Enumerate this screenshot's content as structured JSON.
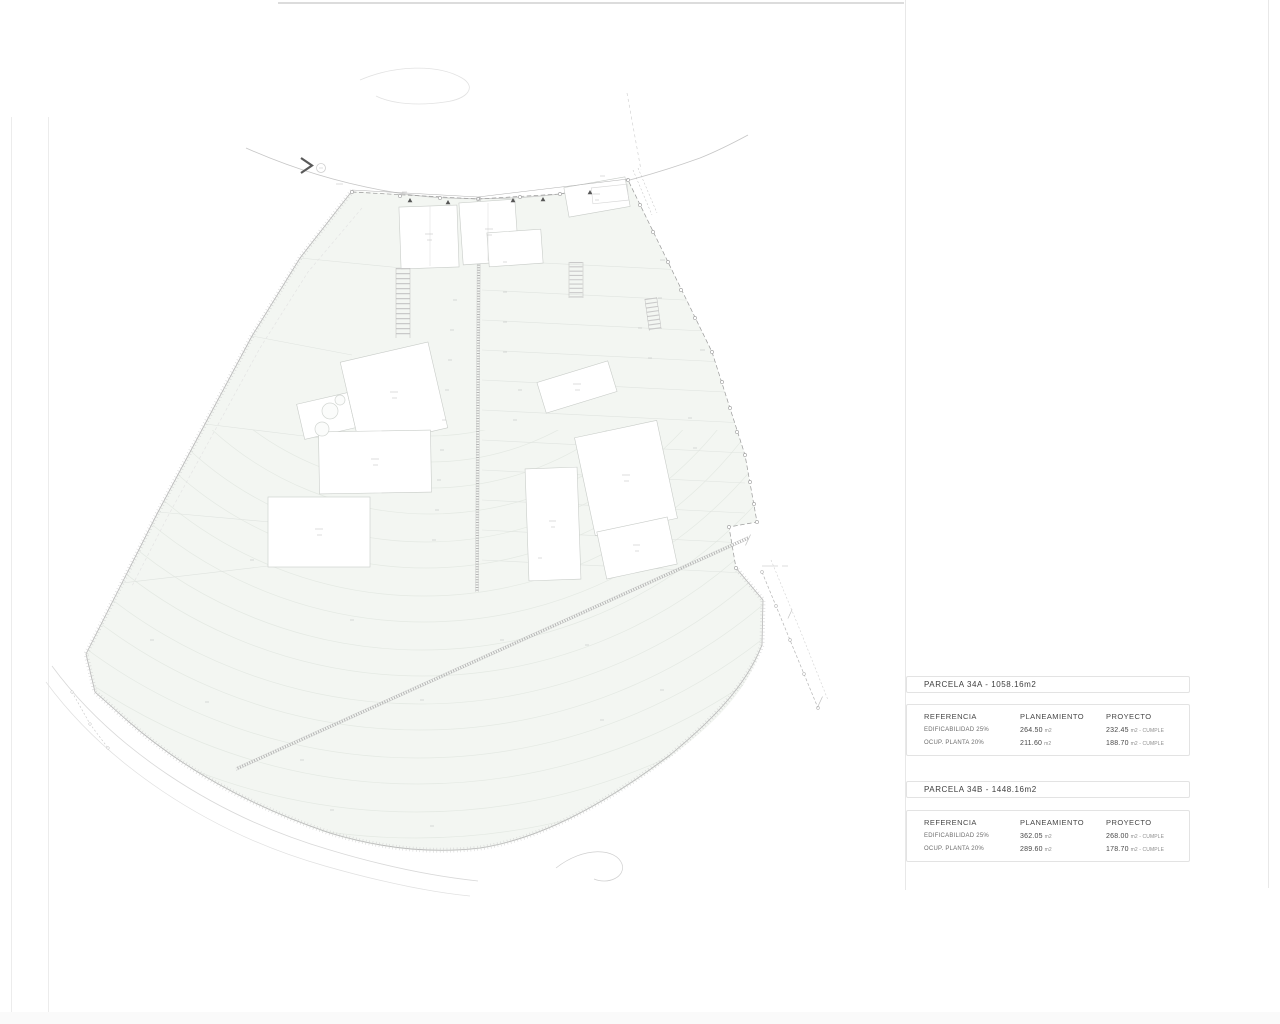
{
  "plan": {
    "description": "architectural site plan with two parcels, terraces, buildings and survey boundary",
    "compass_icon": "chevron-right",
    "colors": {
      "parcel_fill": "#f3f6f2",
      "contour_line": "#e4e9e3",
      "faint_line": "#e0e4e0",
      "boundary_line": "#b5b5b5",
      "survey_dash": "#9a9a9a",
      "building_stroke": "#c8ccc8",
      "arrow_dark": "#5a5a5a"
    }
  },
  "panel": {
    "tables": [
      {
        "title": "PARCELA 34A - 1058.16m2",
        "headers": [
          "REFERENCIA",
          "PLANEAMIENTO",
          "PROYECTO"
        ],
        "rows": [
          {
            "ref": "EDIFICABILIDAD 25%",
            "plan_value": "264.50",
            "plan_unit": "m2",
            "proj_value": "232.45",
            "proj_unit": "m2 - CUMPLE"
          },
          {
            "ref": "OCUP. PLANTA 20%",
            "plan_value": "211.60",
            "plan_unit": "m2",
            "proj_value": "188.70",
            "proj_unit": "m2 - CUMPLE"
          }
        ]
      },
      {
        "title": "PARCELA 34B - 1448.16m2",
        "headers": [
          "REFERENCIA",
          "PLANEAMIENTO",
          "PROYECTO"
        ],
        "rows": [
          {
            "ref": "EDIFICABILIDAD 25%",
            "plan_value": "362.05",
            "plan_unit": "m2",
            "proj_value": "268.00",
            "proj_unit": "m2 - CUMPLE"
          },
          {
            "ref": "OCUP. PLANTA 20%",
            "plan_value": "289.60",
            "plan_unit": "m2",
            "proj_value": "178.70",
            "proj_unit": "m2 - CUMPLE"
          }
        ]
      }
    ]
  }
}
